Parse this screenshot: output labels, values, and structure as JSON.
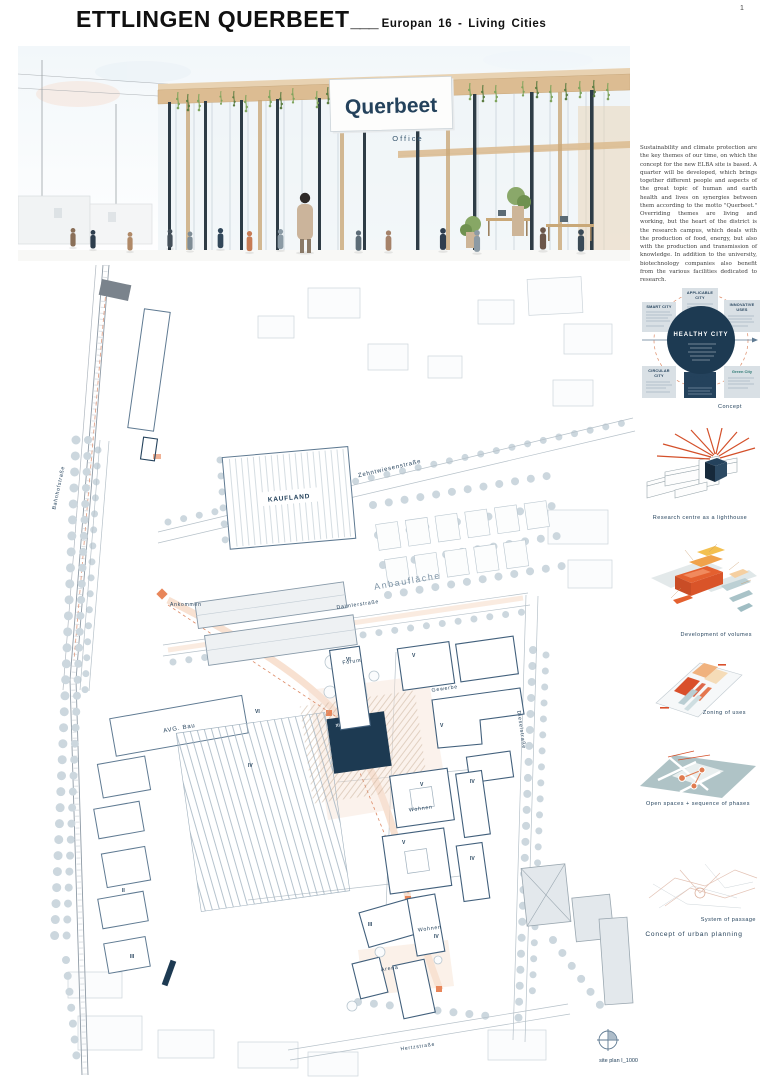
{
  "page_number": "1",
  "header": {
    "title": "ETTLINGEN QUERBEET",
    "rule": "___",
    "subtitle": "Europan 16 - Living Cities"
  },
  "hero": {
    "sign_title": "Querbeet",
    "sign_subtitle": "Office"
  },
  "intro_text": "Sustainability and climate protection are the key themes of our time, on which the concept for the new ELBA site is based. A quarter will be developed, which brings together different people and aspects of the great topic of human and earth health and lives on synergies between them according to the motto \"Querbeet.\" Overriding themes are living and working, but the heart of the district is the research campus, which deals with the production of food, energy, but also with the production and transmission of knowledge. In addition to the university, biotechnology companies also benefit from the various facilities dedicated to research.",
  "sidebar": {
    "concept": {
      "center_label": "HEALTHY CITY",
      "boxes": {
        "smart": "SMART CITY",
        "applicable_1": "APPLICABLE",
        "applicable_2": "CITY",
        "innovative_1": "INNOVATIVE",
        "innovative_2": "USES",
        "circular_1": "CIRCULAR",
        "circular_2": "CITY",
        "adaptive_1": "ADAPTIVE",
        "adaptive_2": "CITY",
        "green": "Green City"
      },
      "caption": "Concept"
    },
    "captions": {
      "lighthouse": "Research centre as a lighthouse",
      "volumes": "Development of volumes",
      "zoning": "Zoning of uses",
      "open_spaces": "Open spaces + sequence of phases",
      "passage": "System of passage"
    },
    "section_heading": "Concept of urban planning"
  },
  "site_plan": {
    "streets": {
      "zehntwiesen": "Zehntwiesenstraße",
      "bahnhof": "Bahnhofstraße",
      "daimler": "Daimlerstraße",
      "diesel": "Dieselstraße",
      "hertz": "Hertzstraße"
    },
    "labels": {
      "kaufland": "KAUFLAND",
      "anbauflaeche": "Anbaufläche",
      "ankommen": "Ankommen",
      "forum": "Forum",
      "gewerbe": "Gewerbe",
      "avg_bau": "AVG. Bau",
      "wohnen_1": "Wohnen",
      "wohnen_2": "Wohnen",
      "arena": "Arena"
    },
    "levels": [
      "VI",
      "V",
      "VI",
      "V",
      "XIII",
      "IV",
      "V",
      "IV",
      "V",
      "IV",
      "IV",
      "III",
      "II",
      "III"
    ],
    "caption": "site plan I_1000"
  },
  "colors": {
    "navy": "#1d3a52",
    "accent_orange": "#d4502a",
    "peach": "#f3d2bc",
    "plan_line": "#5f7a92",
    "teal": "#9fb6ba"
  }
}
